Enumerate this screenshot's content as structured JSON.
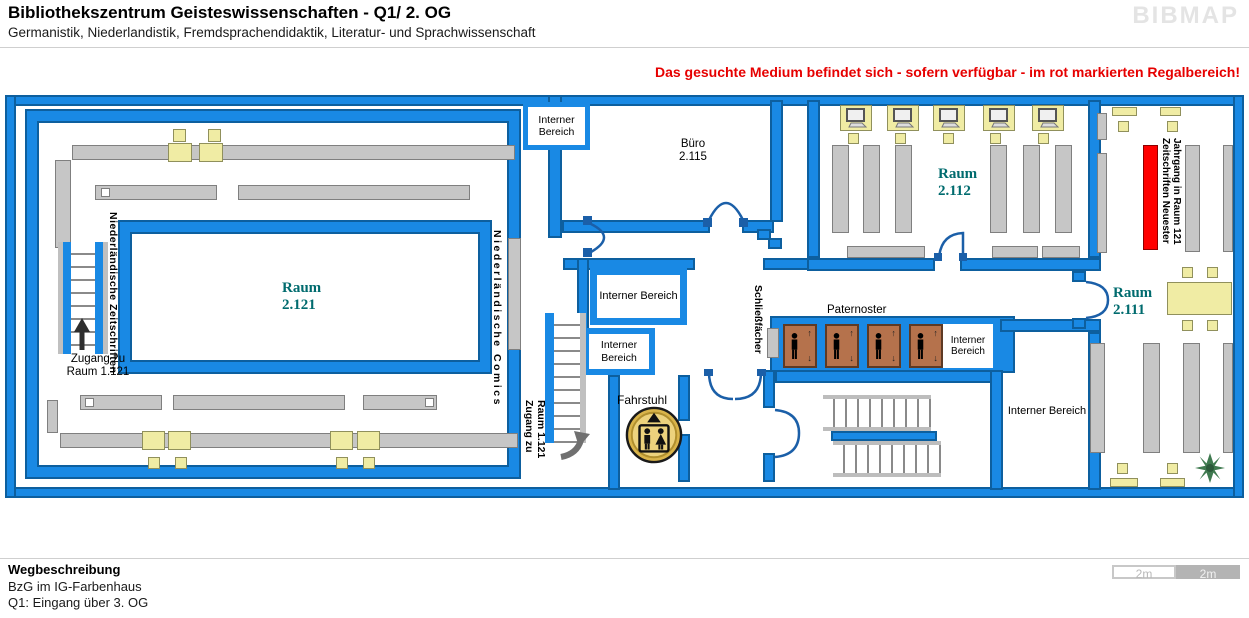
{
  "header": {
    "title": "Bibliothekszentrum Geisteswissenschaften - Q1/ 2. OG",
    "subtitle": "Germanistik, Niederlandistik, Fremdsprachendidaktik, Literatur- und Sprachwissenschaft",
    "logo": "BIBMAP"
  },
  "notice": "Das gesuchte Medium befindet sich - sofern verfügbar -  im rot markierten Regalbereich!",
  "rooms": {
    "r2121": {
      "name": "Raum",
      "number": "2.121"
    },
    "r2112": {
      "name": "Raum",
      "number": "2.112"
    },
    "r2111": {
      "name": "Raum",
      "number": "2.111"
    },
    "buero": {
      "name": "Büro",
      "number": "2.115"
    }
  },
  "labels": {
    "interner_bereich": "Interner Bereich",
    "fahrstuhl": "Fahrstuhl",
    "paternoster": "Paternoster",
    "schliessfaecher": "Schließfächer",
    "zugang_line1": "Zugang zu",
    "zugang_line2": "Raum 1.121",
    "nl_zeitschriften": "Niederländische Zeitschriften",
    "nl_comics": "Niederländische Comics",
    "red_shelf_line1": "Zeitschriften Neuester",
    "red_shelf_line2": "Jahrgang in Raum 121"
  },
  "icons": {
    "up_arrow": "↑",
    "down_arrow": "↓"
  },
  "footer": {
    "heading": "Wegbeschreibung",
    "line1": "BzG im IG-Farbenhaus",
    "line2": "Q1: Eingang über 3. OG"
  },
  "scalebar": {
    "left": "2m",
    "right": "2m"
  },
  "colors": {
    "wall": "#1989E4",
    "wall_outline": "#0D5F9E",
    "shelf": "#C6C6C6",
    "table": "#F0ECA4",
    "highlight_red": "#FF0000",
    "room_label_teal": "#006B6E",
    "paternoster_brown": "#B5724C"
  }
}
